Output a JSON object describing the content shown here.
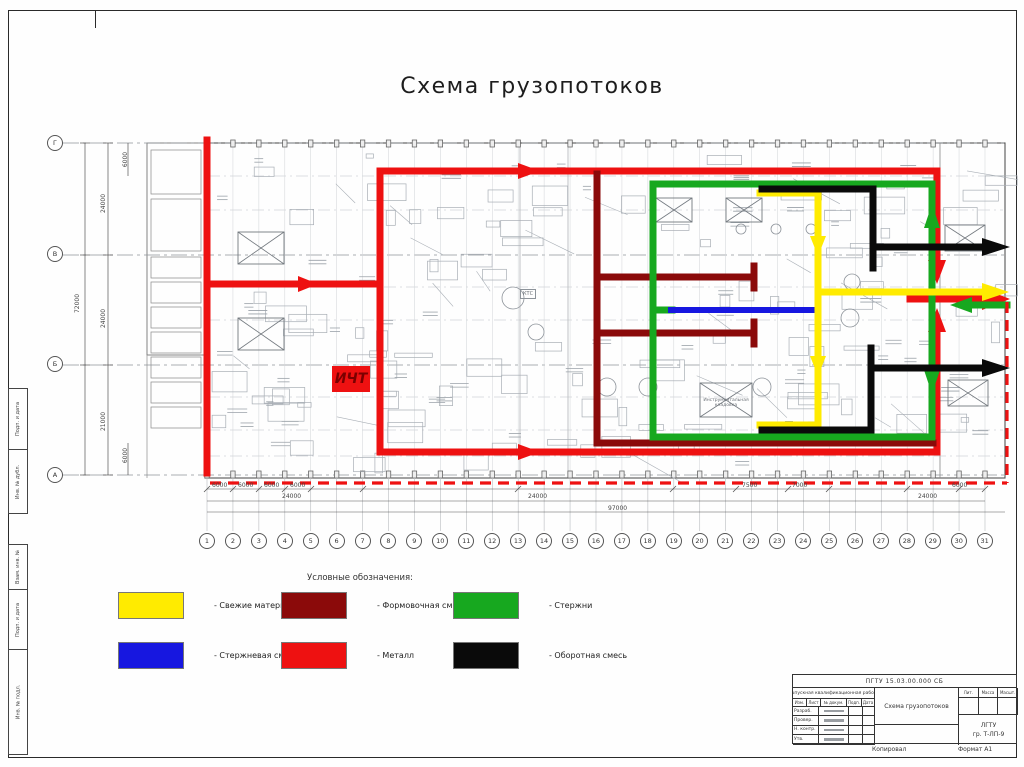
{
  "sheet": {
    "title": "Схема грузопотоков"
  },
  "plan": {
    "icht_label": "ИЧТ",
    "row_axes": [
      "Г",
      "В",
      "Б",
      "А"
    ],
    "col_axes": [
      "1",
      "2",
      "3",
      "4",
      "5",
      "6",
      "7",
      "8",
      "9",
      "10",
      "11",
      "12",
      "13",
      "14",
      "15",
      "16",
      "17",
      "18",
      "19",
      "20",
      "21",
      "22",
      "23",
      "24",
      "25",
      "26",
      "27",
      "28",
      "29",
      "30",
      "31"
    ],
    "room_labels": {
      "ktc": "КТС",
      "tool_room_line1": "Инструментальная",
      "tool_room_line2": "кладовка"
    },
    "dims": {
      "left_total": "72000",
      "left_top_small": "6000",
      "left_seg1": "24000",
      "left_seg2": "24000",
      "left_seg3": "21000",
      "left_bottom_small": "6000",
      "b1": "6000",
      "b2": "6000",
      "b3": "6000",
      "b4": "6000",
      "b5": "24000",
      "b6": "24000",
      "b7": "7500",
      "b8": "7000",
      "b9": "24000",
      "b10": "6000",
      "b11": "97000"
    }
  },
  "flows": {
    "fresh": "#ffeb00",
    "molding": "#8b0a0a",
    "rods": "#17a81f",
    "rodmix": "#1717e0",
    "metal": "#ee1111",
    "return": "#0a0a0a"
  },
  "legend": {
    "title": "Условные обозначения:",
    "items": [
      {
        "color": "#ffeb00",
        "label": "- Свежие материалы"
      },
      {
        "color": "#8b0a0a",
        "label": "- Формовочная смесь"
      },
      {
        "color": "#17a81f",
        "label": "- Стержни"
      },
      {
        "color": "#1717e0",
        "label": "- Стержневая смесь"
      },
      {
        "color": "#ee1111",
        "label": "- Металл"
      },
      {
        "color": "#0a0a0a",
        "label": "- Оборотная смесь"
      }
    ]
  },
  "title_block": {
    "doc_number": "ПГТУ 15.03.00.000 СБ",
    "work_type": "Выпускная квалификационная работа",
    "header": [
      "Изм.",
      "Лист",
      "№ докум.",
      "Подп.",
      "Дата"
    ],
    "roles": [
      "Разраб.",
      "Провер.",
      "Н. контр.",
      "Утв."
    ],
    "drawing_title": "Схема грузопотоков",
    "lit_label": "Лит.",
    "mass_label": "Масса",
    "scale_label": "Масшт.",
    "org_line1": "ЛГТУ",
    "org_line2": "гр. Т-ЛП-9",
    "copied_label": "Копировал",
    "format_label": "Формат  А1"
  },
  "frame": {
    "left_labels": [
      "Подп. и дата",
      "Инв. № дубл.",
      "Взам. инв. №",
      "Подп. и дата",
      "Инв. № подл."
    ]
  }
}
